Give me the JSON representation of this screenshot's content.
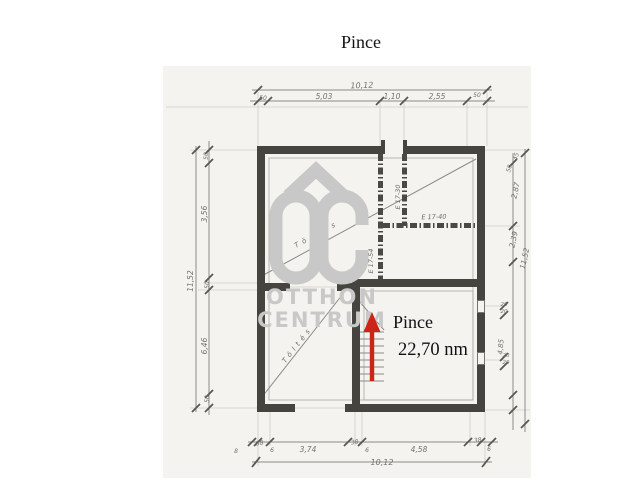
{
  "page": {
    "title": "Pince"
  },
  "watermark": {
    "logo": "OC",
    "line1": "OTTHON",
    "line2": "CENTRUM",
    "color": "#c8c8c8"
  },
  "room": {
    "name": "Pince",
    "area": "22,70 nm"
  },
  "notes": {
    "fill1": "Töltés",
    "fill2": "Töltés"
  },
  "partition_labels": {
    "left_vertical": "E 17-54",
    "mid_horizontal": "E 17-40",
    "right_vertical": "E 17-30"
  },
  "dimensions": {
    "top": {
      "overall": "10,12",
      "segments": [
        "50",
        "5,03",
        "1,10",
        "2,55",
        "50"
      ]
    },
    "bottom": {
      "overall": "10,12",
      "lead": "8",
      "segments": [
        "38",
        "6",
        "3,74",
        "38",
        "6",
        "4,58",
        "38",
        "6"
      ]
    },
    "left": {
      "overall": "11,52",
      "segments": [
        "50",
        "3,56",
        "50",
        "6,46",
        "50"
      ]
    },
    "right": {
      "overall": "11,52",
      "segments": [
        "45",
        "50",
        "2,87",
        "2,39",
        "4,85"
      ],
      "window_dims": [
        "20",
        "20",
        "20",
        "20"
      ]
    }
  },
  "colors": {
    "arrow": "#cc2418",
    "ink": "#45443f",
    "pencil": "#8b8b85",
    "paper": "#f4f3ef",
    "watermark": "#c8c8c8"
  }
}
